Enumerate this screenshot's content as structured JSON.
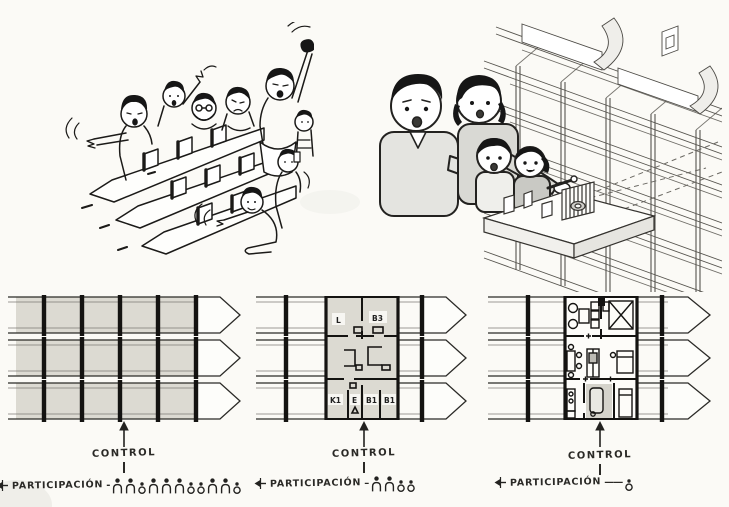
{
  "page": {
    "ink": "#232220",
    "plan_fill": "#dcdad2",
    "paper": "#fbfaf6"
  },
  "plans": [
    {
      "control_label": "CONTROL",
      "participation_label": "PARTICIPACIÓN",
      "separator": "-",
      "participants": [
        "adult",
        "adult",
        "child",
        "adult",
        "adult",
        "adult",
        "child",
        "child",
        "adult",
        "adult",
        "child"
      ]
    },
    {
      "control_label": "CONTROL",
      "participation_label": "PARTICIPACIÓN",
      "separator": "–",
      "rooms": {
        "living": "L",
        "bed3": "B3",
        "kitchen": "K1",
        "entry": "E",
        "bed1a": "B1",
        "bed1b": "B1"
      },
      "participants": [
        "adult",
        "adult",
        "child",
        "child"
      ]
    },
    {
      "control_label": "CONTROL",
      "participation_label": "PARTICIPACIÓN",
      "separator": "——",
      "participants": [
        "child"
      ]
    }
  ]
}
